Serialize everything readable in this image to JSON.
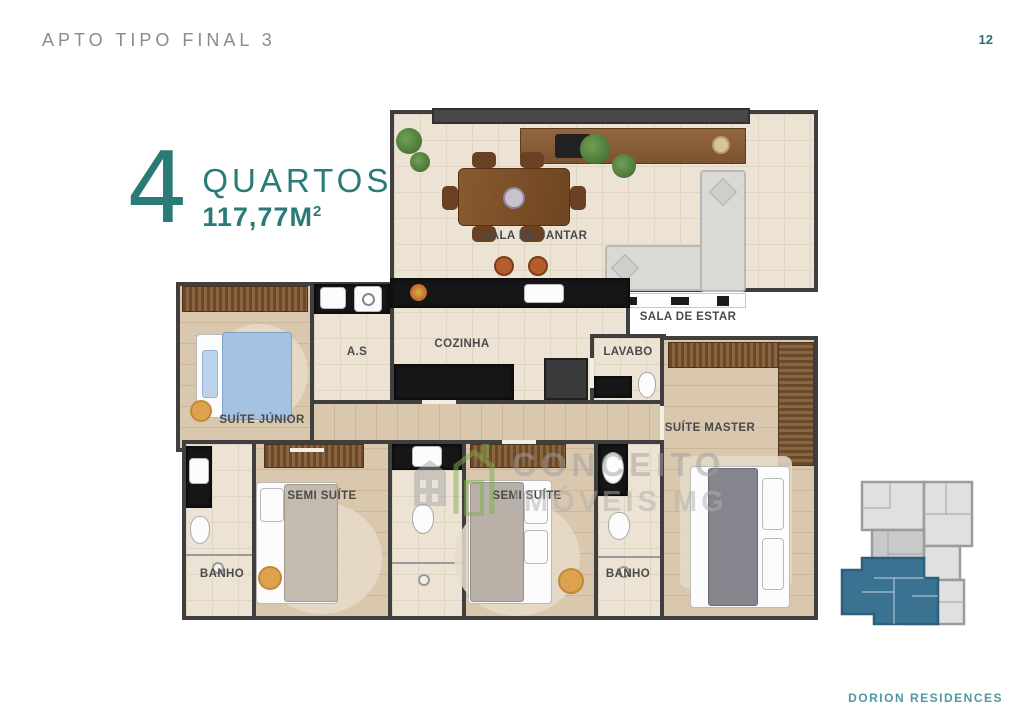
{
  "page": {
    "title": "APTO TIPO FINAL 3",
    "number": "12"
  },
  "footer": {
    "brand": "DORION RESIDENCES"
  },
  "unit": {
    "bedrooms_count": "4",
    "bedrooms_label": "QUARTOS",
    "area": "117,77M",
    "area_sup": "2"
  },
  "rooms": {
    "sala_de_jantar": "SALA DE JANTAR",
    "sala_de_estar": "SALA DE ESTAR",
    "cozinha": "COZINHA",
    "area_servico": "A.S",
    "lavabo": "LAVABO",
    "suite_junior": "SUÍTE JÚNIOR",
    "suite_master": "SUÍTE MASTER",
    "semi_suite_1": "SEMI SUÍTE",
    "semi_suite_2": "SEMI SUÍTE",
    "banho_1": "BANHO",
    "banho_2": "BANHO"
  },
  "watermark": {
    "line1": "CONCEITO",
    "line2": "IMÓVEIS MG"
  },
  "colors": {
    "accent_teal": "#2a7a77",
    "footer_teal": "#4d9aa0",
    "title_gray": "#8b8b8b",
    "wall": "#3f3f3f",
    "keyplan_highlight": "#3a7392"
  }
}
